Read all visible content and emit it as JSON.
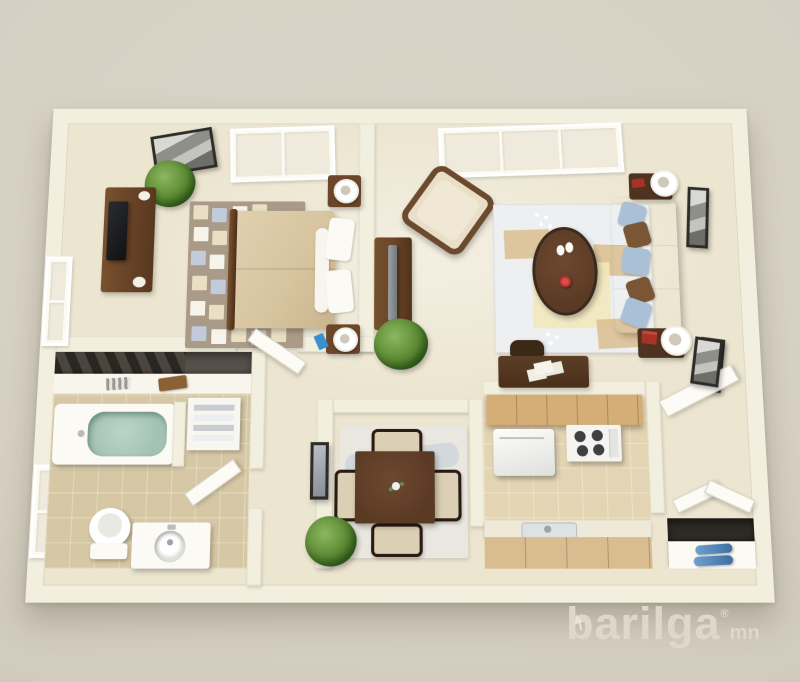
{
  "meta": {
    "description": "3D rendered top-down floor plan of a one-bedroom apartment"
  },
  "watermark": {
    "brand": "barilga",
    "registered": "®",
    "tld": "mn"
  },
  "palette": {
    "bg": "#d6d0c3",
    "wall": "#f3efde",
    "floor": "#ece5d0",
    "tile_bath": "#d7c8a5",
    "tile_kitchen": "#e3d5b3",
    "wood_dark": "#5b3a24",
    "wood_mid": "#6b4629",
    "cabinet": "#d4ad77",
    "counter_wood": "#d9bd91",
    "cream_fabric": "#e6dcc2",
    "duvet": "#d7c5a0",
    "pillow_blue": "#a9c0d6",
    "pillow_brown": "#7a5634",
    "water": "#a2c2b5",
    "rug_taupe": "#a99b87",
    "rug_living": "#edeff1",
    "plant": "#57862f",
    "wm": "#ded8ca"
  },
  "rooms": [
    {
      "name": "bedroom",
      "furniture": [
        "queen-bed",
        "two-nightstands-with-lamps",
        "dresser-with-tv",
        "checkered-area-rug",
        "potted-plant",
        "wall-art",
        "skylight-window",
        "side-window"
      ]
    },
    {
      "name": "living-room",
      "furniture": [
        "sofa-with-pillows",
        "oval-coffee-table",
        "accent-chair",
        "media-console-with-tv",
        "two-end-tables-with-lamps",
        "area-rug",
        "potted-plant",
        "two-wall-frames",
        "picture-window",
        "writing-desk"
      ]
    },
    {
      "name": "bathroom",
      "furniture": [
        "bathtub",
        "toilet",
        "sink-vanity",
        "towel-shelf",
        "closet-counter",
        "side-window"
      ]
    },
    {
      "name": "dining-room",
      "furniture": [
        "square-dining-table",
        "four-chairs",
        "area-rug",
        "potted-plant",
        "wall-mirror"
      ]
    },
    {
      "name": "kitchen",
      "furniture": [
        "upper-cabinets",
        "refrigerator",
        "stove",
        "counter-with-sink"
      ]
    },
    {
      "name": "entry",
      "furniture": [
        "open-door",
        "closet-double-door",
        "shoe-cabinet",
        "wall-frame"
      ]
    }
  ]
}
